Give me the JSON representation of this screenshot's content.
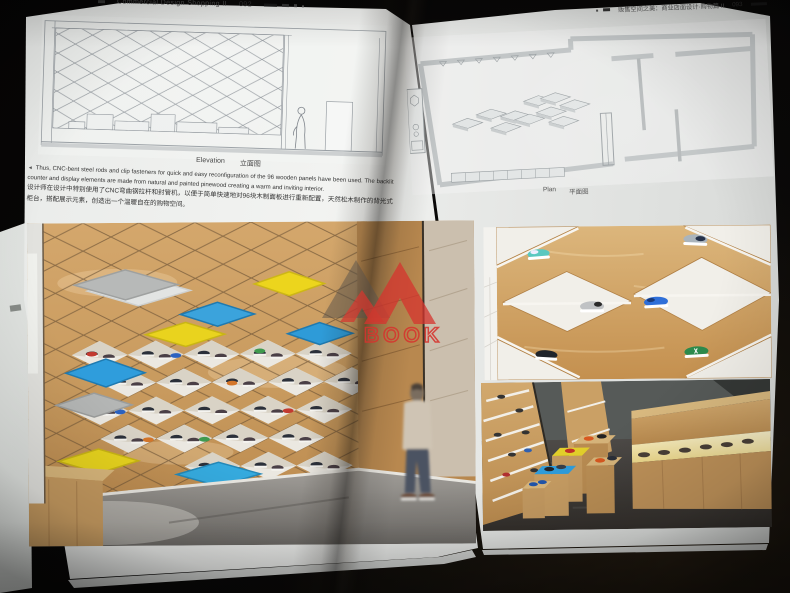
{
  "left_page": {
    "header": {
      "series_title": "Commercial Design Shopping II",
      "page_number": "092"
    },
    "elevation": {
      "caption_en": "Elevation",
      "caption_zh": "立面图"
    },
    "body": {
      "marker": "◄",
      "en": "Thus, CNC-bent steel rods and clip fasteners for quick and easy reconfiguration of the 96 wooden panels have been used. The backlit counter and display elements are made from natural and painted pinewood creating a warm and inviting interior.",
      "zh": "设计师在设计中特别使用了CNC弯曲钢拉杆和封管机，以便于简单快速地对96块木制面板进行重新配置，天然松木制作的背光式柜台，搭配展示元素，创造出一个温暖自在的购物空间。"
    }
  },
  "right_page": {
    "header": {
      "series_title_zh": "贩售空间之美：商业店面设计·购物篇 II",
      "page_number": "093"
    },
    "plan": {
      "caption_en": "Plan",
      "caption_zh": "平面图"
    }
  },
  "watermark": {
    "text": "BOOK",
    "color": "#d6342e"
  },
  "colors": {
    "panel_blue": "#2f9ddc",
    "panel_light_blue": "#35aade",
    "panel_yellow": "#e8d41e",
    "panel_gray": "#b4b6b5",
    "panel_white": "#e4e6e5",
    "plywood": "#cc9e63",
    "page": "#ededeb",
    "background": "#0a0908",
    "watermark_red": "#d6342e"
  }
}
